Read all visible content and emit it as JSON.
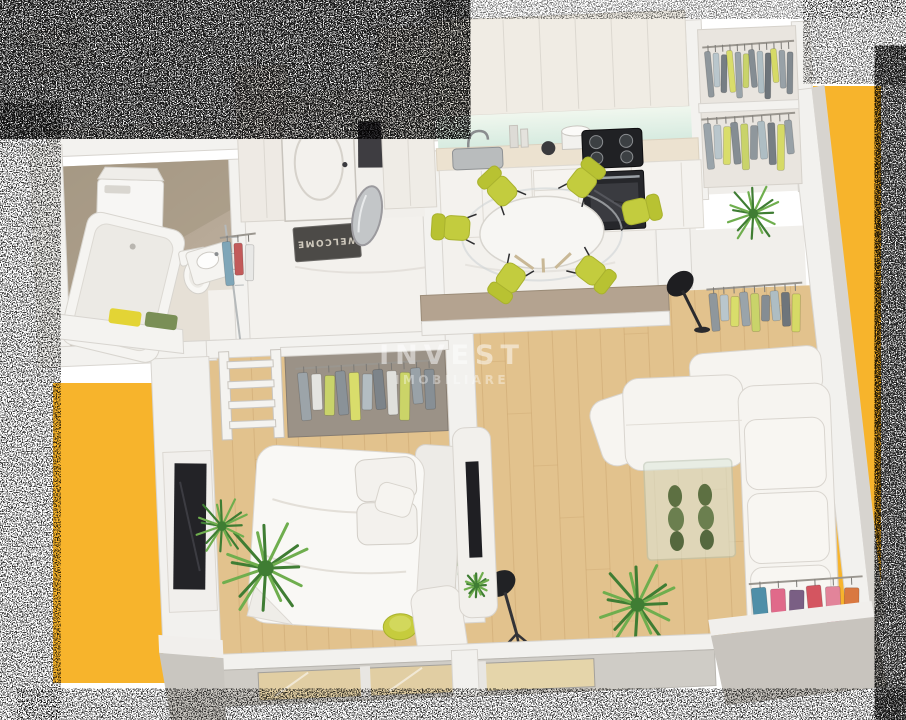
{
  "scene": {
    "title": "apartment-3d-floor-plan-render",
    "watermark": {
      "line1": "INVEST",
      "line2": "IMOBILIARE"
    },
    "entry": {
      "doormat_text": "WELCOME"
    },
    "colors": {
      "background": "#FFFFFF",
      "accent_yellow": "#F7B42C",
      "wall_white": "#F3F2EF",
      "wall_edge": "#D8D5D0",
      "outer_wall_gray": "#C8C4BE",
      "wood_floor": "#E2C28D",
      "wood_plank_line": "#B98F58",
      "marble_floor": "#F3F1ED",
      "bath_tile_wall": "#B2A492",
      "bath_tile_floor": "#C6B8A6",
      "half_wall_brown": "#B4A390",
      "chair_green": "#C3CC3E",
      "chair_green_dark": "#A9B22E",
      "stool_green": "#C6CC3D",
      "appliance_black": "#232327",
      "backsplash_mint": "#DFEFE3",
      "mat_gray": "#4C4A47",
      "mat_text": "#CFC9BD",
      "plant_dark": "#3F7D33",
      "plant_light": "#6FAE4E",
      "sofa_white": "#F6F4F0",
      "glass_tint": "#DDE8DC"
    },
    "wardrobes": {
      "hall_rack": [
        "#7FA6B8",
        "#C25A5A",
        "#E8E8E6"
      ],
      "top_row1": [
        "#8F979C",
        "#B9C6CC",
        "#777E84",
        "#D9DD6B",
        "#9AA4AA",
        "#C9D36A",
        "#858D93",
        "#AEBDC3",
        "#6E757B",
        "#D6DA66",
        "#98A1A7",
        "#828A90"
      ],
      "top_row2": [
        "#9AA4AA",
        "#B9C6CC",
        "#D9DD6B",
        "#858D93",
        "#C9D36A",
        "#8F979C",
        "#AEBDC3",
        "#777E84",
        "#D6DA66",
        "#98A1A7"
      ],
      "corridor_row": [
        "#8F979C",
        "#B9C6CC",
        "#D9DD6B",
        "#9AA4AA",
        "#C9D36A",
        "#858D93",
        "#AEBDC3",
        "#6E757B",
        "#D6DA66"
      ],
      "bedroom_row": [
        "#9CA4A9",
        "#E4E4E0",
        "#C9D36A",
        "#8A9298",
        "#D9DD6B",
        "#B3BDC2",
        "#7D848A",
        "#E0E0DC",
        "#CBD468",
        "#99A2A8",
        "#878F95"
      ],
      "sofa_rack": [
        "#4F8FA8",
        "#E06A8A",
        "#7A5F84",
        "#D45560",
        "#E2849A",
        "#D97840"
      ]
    }
  }
}
